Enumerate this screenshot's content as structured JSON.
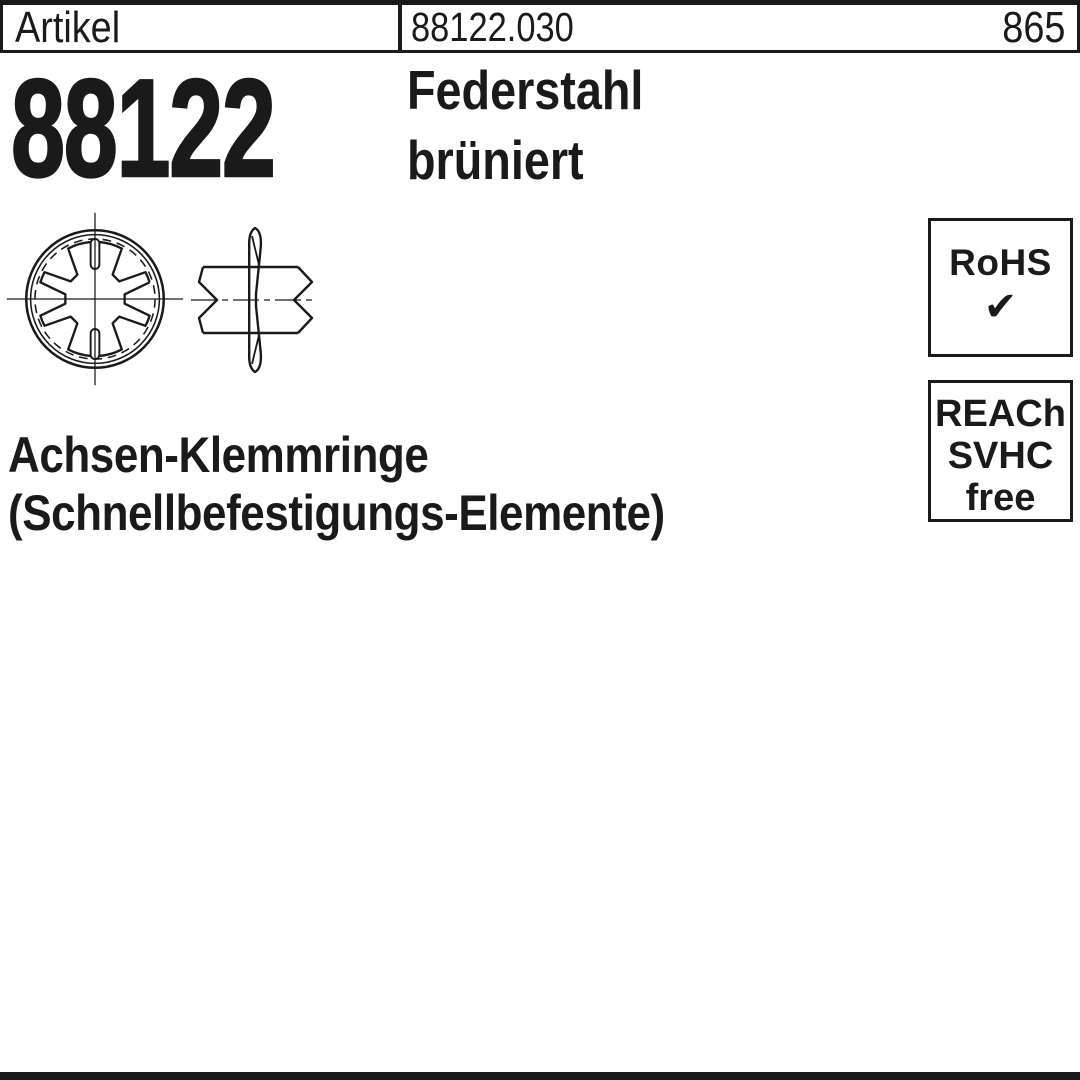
{
  "header": {
    "label": "Artikel",
    "article_number": "88122.030",
    "page_number": "865"
  },
  "hero": {
    "series_number": "88122",
    "material_line1": "Federstahl",
    "material_line2": "brüniert"
  },
  "badges": {
    "rohs": {
      "label": "RoHS",
      "check_icon": "✔"
    },
    "reach": {
      "line1": "REACh",
      "line2": "SVHC",
      "line3": "free"
    }
  },
  "title": {
    "line1": "Achsen-Klemmringe",
    "line2": "(Schnellbefestigungs-Elemente)"
  },
  "drawings": {
    "front_view": "star-lock-washer-front-view",
    "side_view": "star-lock-washer-on-shaft-side-view"
  },
  "colors": {
    "ink": "#1a1a1a",
    "background": "#ffffff"
  }
}
